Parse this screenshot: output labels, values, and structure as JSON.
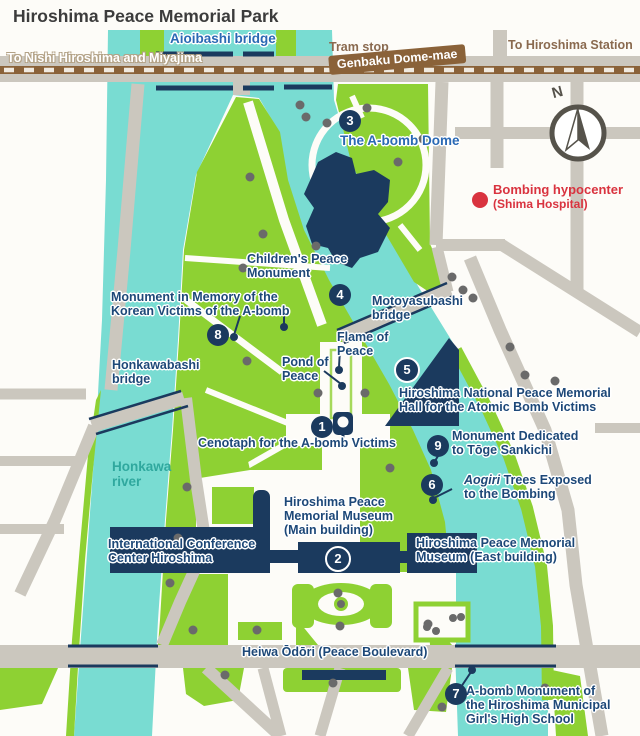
{
  "title": "Hiroshima Peace Memorial Park",
  "compass": {
    "north": "N"
  },
  "transit": {
    "tram_stop": "Tram stop",
    "station_badge": "Genbaku Dome-mae",
    "to_station": "To Hiroshima Station",
    "to_nishi": "To Nishi Hiroshima and Miyajima"
  },
  "hypocenter": {
    "line1": "Bombing hypocenter",
    "line2": "(Shima Hospital)"
  },
  "rivers": {
    "honkawa": {
      "line1": "Honkawa",
      "line2": "river"
    }
  },
  "bridges": {
    "aioibashi": "Aioibashi bridge",
    "motoyasubashi": {
      "line1": "Motoyasubashi",
      "line2": "bridge"
    },
    "honkawabashi": {
      "line1": "Honkawabashi",
      "line2": "bridge"
    }
  },
  "roads": {
    "heiwa_odori": "Heiwa Ōdōri (Peace Boulevard)"
  },
  "sites": {
    "cenotaph": {
      "num": "1",
      "label": "Cenotaph for the A-bomb Victims"
    },
    "museum_main": {
      "num": "2",
      "line1": "Hiroshima Peace",
      "line2": "Memorial Museum",
      "line3": "(Main building)"
    },
    "dome": {
      "num": "3",
      "label": "The A-bomb Dome"
    },
    "childrens": {
      "num": "4",
      "line1": "Children's Peace",
      "line2": "Monument"
    },
    "hall": {
      "num": "5",
      "line1": "Hiroshima National Peace Memorial",
      "line2": "Hall for the Atomic Bomb Victims"
    },
    "aogiri": {
      "num": "6",
      "italic": "Aogiri",
      "line1rest": " Trees Exposed",
      "line2": "to the Bombing"
    },
    "girls": {
      "num": "7",
      "line1": "A-bomb Monument of",
      "line2": "the Hiroshima Municipal",
      "line3": "Girl's High School"
    },
    "korean": {
      "num": "8",
      "line1": "Monument in Memory of the",
      "line2": "Korean Victims of the A-bomb"
    },
    "toge": {
      "num": "9",
      "line1": "Monument Dedicated",
      "line2": "to Tōge Sankichi"
    },
    "flame": {
      "line1": "Flame of",
      "line2": "Peace"
    },
    "pond": {
      "line1": "Pond of",
      "line2": "Peace"
    },
    "museum_east": {
      "line1": "Hiroshima Peace Memorial",
      "line2": "Museum (East building)"
    },
    "icch": {
      "line1": "International Conference",
      "line2": "Center Hiroshima"
    }
  },
  "colors": {
    "water": "#79dcd2",
    "park_green": "#8ed133",
    "building_navy": "#1b3a5e",
    "road_gray": "#cbc7be",
    "tram_brown": "#8a6239",
    "accent_red": "#d9333f",
    "label_navy": "#1d4878",
    "label_blue": "#2a69b4",
    "river_text": "#2fa89e"
  }
}
